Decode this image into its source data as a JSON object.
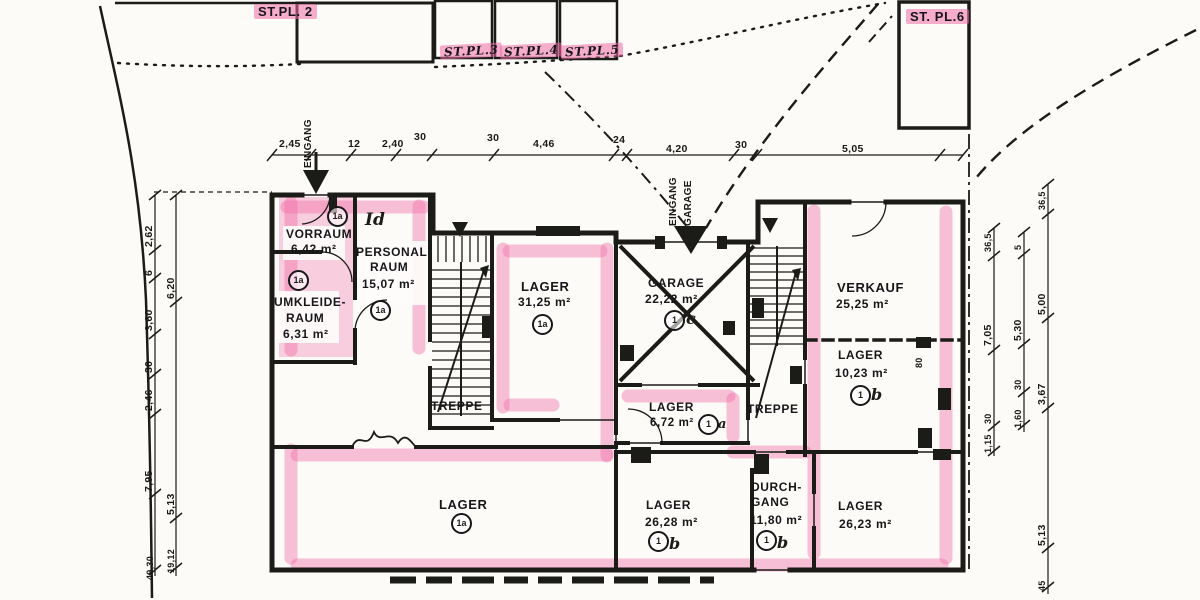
{
  "parking": {
    "stpl2": "ST.PL. 2",
    "stpl3": "ST.PL.3",
    "stpl4": "ST.PL.4",
    "stpl5": "ST.PL.5",
    "stpl6": "ST. PL.6"
  },
  "entrances": {
    "main": "EINGANG",
    "garage_line1": "EINGANG",
    "garage_line2": "GARAGE"
  },
  "rooms": {
    "vorraum": {
      "name": "VORRAUM",
      "area": "6,42 m²",
      "badge": "1a",
      "suffix": ""
    },
    "personalraum": {
      "note": "Id",
      "name1": "PERSONAL",
      "name2": "RAUM",
      "area": "15,07 m²",
      "badge": "1a",
      "suffix": ""
    },
    "umkleideraum": {
      "name1": "UMKLEIDE-",
      "name2": "RAUM",
      "area": "6,31 m²",
      "badge": "1a",
      "suffix": ""
    },
    "lager31": {
      "name": "LAGER",
      "area": "31,25 m²",
      "badge": "1a",
      "suffix": ""
    },
    "treppe_left": {
      "name": "TREPPE"
    },
    "garage": {
      "name": "GARAGE",
      "area": "22,22 m²",
      "badge": "1",
      "suffix": "c"
    },
    "treppe_right": {
      "name": "TREPPE"
    },
    "verkauf": {
      "name": "VERKAUF",
      "area": "25,25 m²"
    },
    "lager1023": {
      "name": "LAGER",
      "area": "10,23 m²",
      "badge": "1",
      "suffix": "b"
    },
    "lager672": {
      "name": "LAGER",
      "area": "6,72 m²",
      "badge": "1",
      "suffix": "a"
    },
    "lager_main": {
      "name": "LAGER",
      "badge": "1a",
      "suffix": ""
    },
    "lager2628": {
      "name": "LAGER",
      "area": "26,28 m²",
      "badge": "1",
      "suffix": "b"
    },
    "durchgang": {
      "name1": "DURCH-",
      "name2": "GANG",
      "area": "11,80 m²",
      "badge": "1",
      "suffix": "b"
    },
    "lager2623": {
      "name": "LAGER",
      "area": "26,23 m²"
    }
  },
  "dims": {
    "top": [
      "2,45",
      "12",
      "2,40",
      "30",
      "30",
      "4,46",
      "24",
      "4,20",
      "30",
      "5,05"
    ],
    "left_outer": [
      "2,62",
      "6",
      "3,60",
      "30",
      "2,46",
      "7,95",
      "49,30"
    ],
    "left_inner": [
      "6,20",
      "5,13",
      "19,12"
    ],
    "right_inner": [
      "36,5",
      "7,05",
      "30",
      "1,15"
    ],
    "right_mid": [
      "5",
      "5,30",
      "30",
      "1,60"
    ],
    "right_outer": [
      "36,5",
      "5,00",
      "3,67",
      "5,13",
      "45"
    ],
    "wall": [
      "80"
    ]
  },
  "colors": {
    "highlight": "#f06ca8",
    "ink": "#1b1b18",
    "paper": "#fcfbf7"
  }
}
